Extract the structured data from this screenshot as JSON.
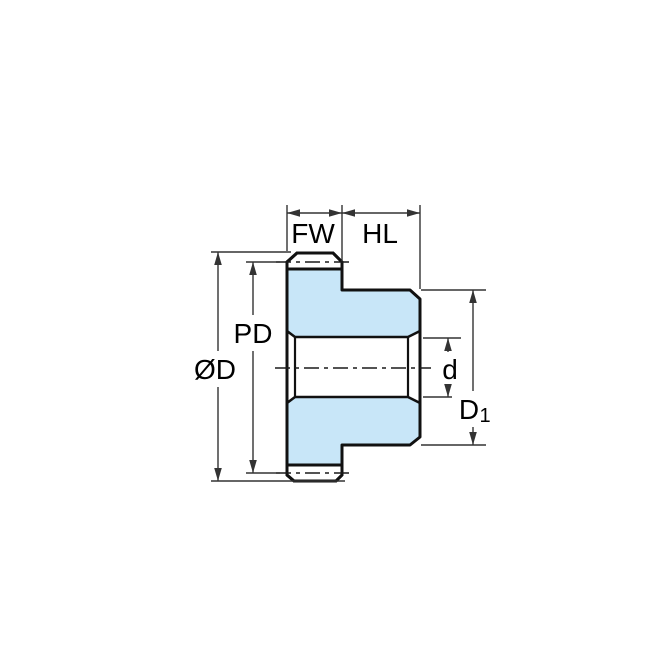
{
  "drawing": {
    "title": "Spur gear with hub - cross-section dimension diagram",
    "labels": {
      "face_width": "FW",
      "hub_length": "HL",
      "pitch_diameter": "PD",
      "outside_diameter": "ØD",
      "bore_diameter": "d",
      "hub_diameter_main": "D",
      "hub_diameter_sub": "1"
    },
    "colors": {
      "part_fill": "#c8e6f8",
      "outline": "#111111",
      "dimension_lines": "#333333",
      "background": "#ffffff"
    }
  }
}
